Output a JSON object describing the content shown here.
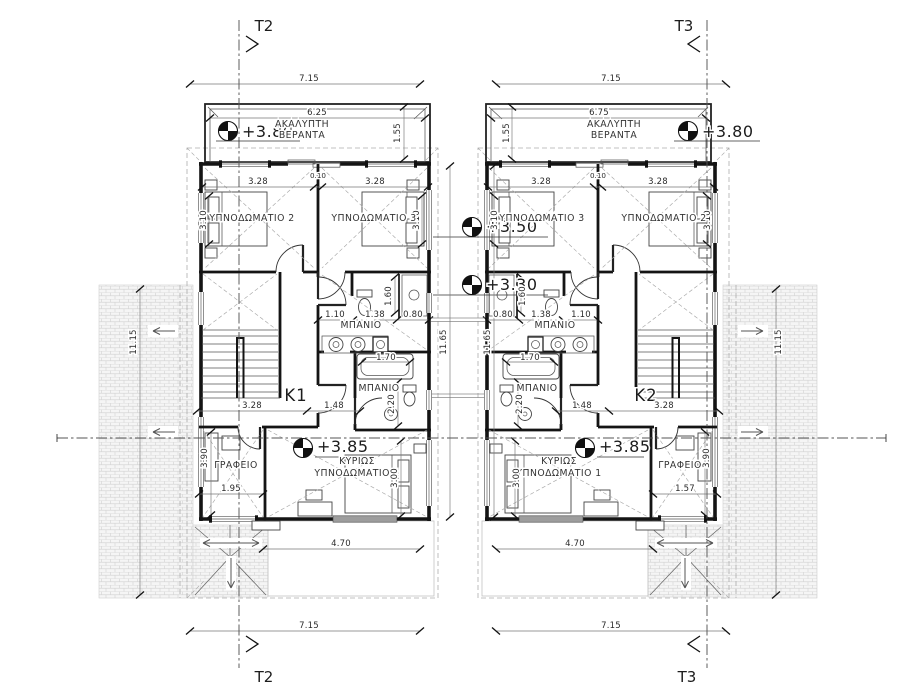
{
  "sections": {
    "t2": "T2",
    "t3": "T3"
  },
  "levels": {
    "veranda": "+3.80",
    "mid_upper": "+3.50",
    "mid_lower": "+3.30",
    "floor": "+3.85"
  },
  "k1": {
    "label": "K1",
    "veranda": {
      "line1": "ΑΚΑΛΥΠΤΗ",
      "line2": "ΒΕΡΑΝΤΑ"
    },
    "rooms": {
      "bedroom2": "ΥΠΝΟΔΩΜΑΤΙΟ 2",
      "bedroom3": "ΥΠΝΟΔΩΜΑΤΙΟ 3",
      "bath": "ΜΠΑΝΙΟ",
      "office": "ΓΡΑΦΕΙΟ",
      "master1": "ΚΥΡΙΩΣ",
      "master2": "ΥΠΝΟΔΩΜΑΤΙΟ 1"
    },
    "dims": {
      "total_w": "7.15",
      "veranda_w": "6.25",
      "veranda_d": "1.55",
      "bed_w1": "3.28",
      "wall": "0.10",
      "bed_w2": "3.28",
      "bed_d1": "3.10",
      "bed_d2": "3.10",
      "bath_a": "1.10",
      "bath_b": "1.38",
      "bath_c": "0.80",
      "shower_d": "1.60",
      "tub_w": "1.70",
      "bath2_d": "2.20",
      "low_a": "3.28",
      "low_b": "1.48",
      "office_d": "3.90",
      "office_w": "1.95",
      "master_d": "3.00",
      "bottom_w": "4.70",
      "total_w_b": "7.15",
      "depth": "11.65",
      "roof_side": "11.15"
    }
  },
  "k2": {
    "label": "K2",
    "veranda": {
      "line1": "ΑΚΑΛΥΠΤΗ",
      "line2": "ΒΕΡΑΝΤΑ"
    },
    "rooms": {
      "bedroom2": "ΥΠΝΟΔΩΜΑΤΙΟ 2",
      "bedroom3": "ΥΠΝΟΔΩΜΑΤΙΟ 3",
      "bath": "ΜΠΑΝΙΟ",
      "office": "ΓΡΑΦΕΙΟ",
      "master1": "ΚΥΡΙΩΣ",
      "master2": "ΥΠΝΟΔΩΜΑΤΙΟ 1"
    },
    "dims": {
      "total_w": "7.15",
      "veranda_w": "6.75",
      "veranda_d": "1.55",
      "bed_w1": "3.28",
      "wall": "0.10",
      "bed_w2": "3.28",
      "bed_d1": "3.10",
      "bed_d2": "3.10",
      "bath_a": "1.10",
      "bath_b": "1.38",
      "bath_c": "0.80",
      "shower_d": "1.60",
      "tub_w": "1.70",
      "bath2_d": "2.20",
      "low_a": "3.28",
      "low_b": "1.48",
      "office_d": "3.90",
      "office_w": "1.57",
      "master_d": "3.00",
      "bottom_w": "4.70",
      "total_w_b": "7.15",
      "depth": "11.65",
      "roof_side": "11.15"
    }
  }
}
